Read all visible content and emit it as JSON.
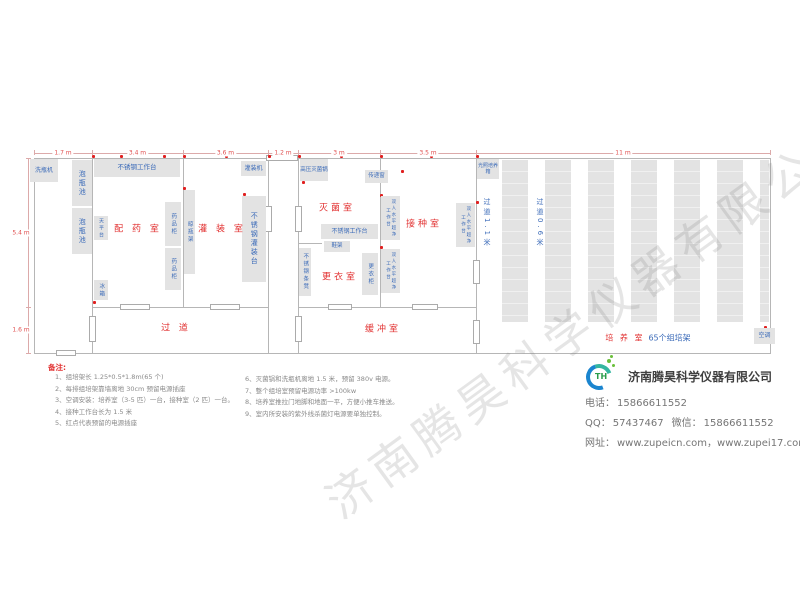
{
  "watermark": "济南腾昊科学仪器有限公司",
  "plan": {
    "dimensions": {
      "top": [
        {
          "label": "1.7 m",
          "from": 34,
          "to": 92
        },
        {
          "label": "3.4 m",
          "from": 92,
          "to": 183
        },
        {
          "label": "3.6 m",
          "from": 183,
          "to": 268
        },
        {
          "label": "1.2 m",
          "from": 268,
          "to": 298
        },
        {
          "label": "3 m",
          "from": 298,
          "to": 380
        },
        {
          "label": "3.5 m",
          "from": 380,
          "to": 476
        },
        {
          "label": "11 m",
          "from": 476,
          "to": 770
        }
      ],
      "left": [
        {
          "label": "5.4 m",
          "from": 158,
          "to": 307
        },
        {
          "label": "1.6 m",
          "from": 307,
          "to": 353
        }
      ]
    },
    "rooms": [
      {
        "name": "prep-room",
        "label": "配 药 室",
        "cx": 138,
        "cy": 228
      },
      {
        "name": "filling-room",
        "label": "灌 装 室",
        "cx": 222,
        "cy": 228
      },
      {
        "name": "sterilization-room",
        "label": "灭菌室",
        "cx": 337,
        "cy": 207
      },
      {
        "name": "changing-room",
        "label": "更衣室",
        "cx": 340,
        "cy": 276
      },
      {
        "name": "inoculation-room",
        "label": "接种室",
        "cx": 424,
        "cy": 223
      },
      {
        "name": "corridor",
        "label": "过 道",
        "cx": 176,
        "cy": 327
      },
      {
        "name": "buffer-room",
        "label": "缓冲室",
        "cx": 383,
        "cy": 328
      }
    ],
    "aisles": [
      {
        "label": "过道1.1米",
        "x": 482,
        "y": 198
      },
      {
        "label": "过道0.6米",
        "x": 535,
        "y": 198
      }
    ],
    "culture_label": {
      "red": "培 养 室",
      "blue": "65个组培架",
      "cx": 648,
      "cy": 338
    },
    "racks": {
      "count": 7,
      "x0": 502,
      "pitch": 43,
      "width": 26,
      "y": 160,
      "h": 162,
      "clip": 769
    },
    "equipment": [
      {
        "name": "bottle-washer",
        "label": "洗瓶机",
        "x": 30,
        "y": 159,
        "w": 28,
        "h": 23,
        "dir": "h"
      },
      {
        "name": "soak-pool-1",
        "label": "泡瓶池",
        "x": 72,
        "y": 160,
        "w": 20,
        "h": 46,
        "dir": "v",
        "fs": 7
      },
      {
        "name": "soak-pool-2",
        "label": "泡瓶池",
        "x": 72,
        "y": 208,
        "w": 20,
        "h": 46,
        "dir": "v",
        "fs": 7
      },
      {
        "name": "worktable-prep",
        "label": "不锈钢工作台",
        "x": 94,
        "y": 159,
        "w": 86,
        "h": 18,
        "dir": "h",
        "fs": 6.5
      },
      {
        "name": "balance-table",
        "label": "天平台",
        "x": 94,
        "y": 216,
        "w": 14,
        "h": 24,
        "dir": "v",
        "fs": 5
      },
      {
        "name": "fridge",
        "label": "冰箱",
        "x": 94,
        "y": 280,
        "w": 14,
        "h": 20,
        "dir": "v",
        "fs": 5.5
      },
      {
        "name": "medicine-cabinet-1",
        "label": "药品柜",
        "x": 165,
        "y": 202,
        "w": 16,
        "h": 44,
        "dir": "v",
        "fs": 5.5
      },
      {
        "name": "medicine-cabinet-2",
        "label": "药品柜",
        "x": 165,
        "y": 248,
        "w": 16,
        "h": 42,
        "dir": "v",
        "fs": 5.5
      },
      {
        "name": "bottle-drying-rack",
        "label": "晾瓶架",
        "x": 184,
        "y": 190,
        "w": 11,
        "h": 84,
        "dir": "v",
        "fs": 5.5
      },
      {
        "name": "filling-machine",
        "label": "灌装机",
        "x": 241,
        "y": 161,
        "w": 25,
        "h": 15,
        "dir": "h"
      },
      {
        "name": "filling-table",
        "label": "不锈钢灌装台",
        "x": 242,
        "y": 196,
        "w": 24,
        "h": 86,
        "dir": "v",
        "fs": 7
      },
      {
        "name": "autoclave",
        "label": "高压灭菌锅",
        "x": 300,
        "y": 159,
        "w": 28,
        "h": 22,
        "dir": "h",
        "fs": 5.5
      },
      {
        "name": "pass-window",
        "label": "传递窗",
        "x": 365,
        "y": 170,
        "w": 23,
        "h": 13,
        "dir": "h",
        "fs": 5.5
      },
      {
        "name": "worktable-steril",
        "label": "不锈钢工作台",
        "x": 321,
        "y": 224,
        "w": 57,
        "h": 15,
        "dir": "h"
      },
      {
        "name": "shoe-rack",
        "label": "鞋架",
        "x": 324,
        "y": 241,
        "w": 26,
        "h": 11,
        "dir": "h",
        "fs": 5.5
      },
      {
        "name": "wardrobe",
        "label": "更衣柜",
        "x": 362,
        "y": 253,
        "w": 16,
        "h": 42,
        "dir": "v",
        "fs": 5.5
      },
      {
        "name": "steel-bench",
        "label": "不锈钢条凳",
        "x": 299,
        "y": 248,
        "w": 12,
        "h": 48,
        "dir": "v",
        "fs": 5.5
      },
      {
        "name": "clean-bench-1",
        "label": "双人水平超净工作台",
        "x": 381,
        "y": 196,
        "w": 19,
        "h": 44,
        "dir": "v",
        "fs": 4.5
      },
      {
        "name": "clean-bench-2",
        "label": "双人水平超净工作台",
        "x": 381,
        "y": 249,
        "w": 19,
        "h": 44,
        "dir": "v",
        "fs": 4.5
      },
      {
        "name": "clean-bench-3",
        "label": "双人水平超净工作台",
        "x": 456,
        "y": 203,
        "w": 19,
        "h": 44,
        "dir": "v",
        "fs": 4.5
      },
      {
        "name": "light-incubator",
        "label": "光照培养箱",
        "x": 477,
        "y": 159,
        "w": 22,
        "h": 20,
        "dir": "h",
        "fs": 5
      },
      {
        "name": "air-conditioner",
        "label": "空调",
        "x": 754,
        "y": 328,
        "w": 21,
        "h": 16,
        "dir": "h"
      }
    ]
  },
  "notes": {
    "title": "备注:",
    "col1": [
      "1、组培架长 1.25*0.5*1.8m(65 个)",
      "2、每排组培架靠墙离地 30cm 预留电源插座",
      "3、空调安装：培养室（3-5 匹）一台，接种室（2 匹）一台。",
      "4、接种工作台长为 1.5 米",
      "5、红点代表预留的电源插座"
    ],
    "col2": [
      "6、灭菌锅和洗瓶机离地 1.5 米，预留 380v 电源。",
      "7、整个组培室预留电源功率 >100kw",
      "8、培养室推拉门地脚和地面一平，方便小推车推送。",
      "9、室内所安装的紫外线杀菌灯电源要单独控制。"
    ]
  },
  "company": {
    "name": "济南腾昊科学仪器有限公司",
    "logo_text": "TH",
    "rows": [
      [
        {
          "label": "电话：",
          "value": "15866611552"
        }
      ],
      [
        {
          "label": "QQ：",
          "value": "57437467"
        },
        {
          "label": "微信：",
          "value": "15866611552"
        }
      ],
      [
        {
          "label": "网址：",
          "value": "www.zupeicn.com，www.zupei17.com"
        }
      ]
    ]
  }
}
